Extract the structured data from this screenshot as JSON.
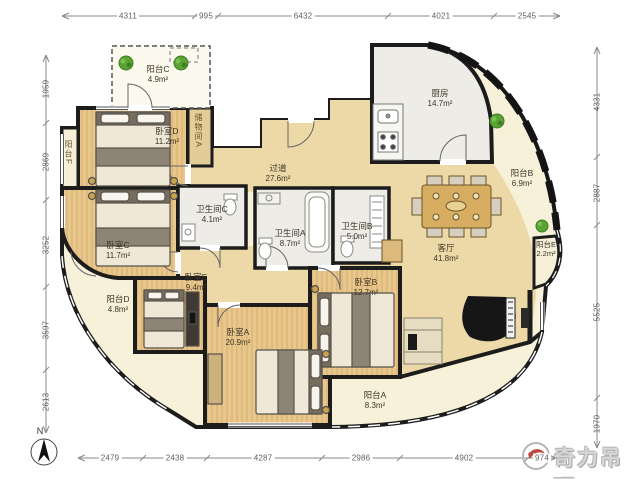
{
  "dimensions": {
    "top": [
      "4311",
      "995",
      "6432",
      "4021",
      "2545"
    ],
    "bottom": [
      "2479",
      "2438",
      "4287",
      "2986",
      "4902",
      "974"
    ],
    "left": [
      "1959",
      "2869",
      "3252",
      "3597",
      "2613"
    ],
    "right": [
      "4331",
      "2887",
      "5525",
      "1970"
    ]
  },
  "rooms": {
    "balcony_c": {
      "name": "阳台C",
      "area": "4.9m²"
    },
    "bedroom_d": {
      "name": "卧室D",
      "area": "11.2m²"
    },
    "storage_a": {
      "name": "储物间A"
    },
    "balcony_f": {
      "name": "阳台F"
    },
    "bedroom_c": {
      "name": "卧室C",
      "area": "11.7m²"
    },
    "bathroom_c": {
      "name": "卫生间C",
      "area": "4.1m²"
    },
    "corridor": {
      "name": "过道",
      "area": "27.6m²"
    },
    "bathroom_a": {
      "name": "卫生间A",
      "area": "8.7m²"
    },
    "bathroom_b": {
      "name": "卫生间B",
      "area": "5.0m²"
    },
    "kitchen": {
      "name": "厨房",
      "area": "14.7m²"
    },
    "balcony_b": {
      "name": "阳台B",
      "area": "6.9m²"
    },
    "living_room": {
      "name": "客厅",
      "area": "41.8m²"
    },
    "balcony_e": {
      "name": "阳台E",
      "area": "2.2m²"
    },
    "bedroom_e": {
      "name": "卧室E",
      "area": "9.4m²"
    },
    "balcony_d": {
      "name": "阳台D",
      "area": "4.8m²"
    },
    "bedroom_a": {
      "name": "卧室A",
      "area": "20.9m²"
    },
    "bedroom_b": {
      "name": "卧室B",
      "area": "12.7m²"
    },
    "balcony_a": {
      "name": "阳台A",
      "area": "8.3m²"
    }
  },
  "compass": {
    "label": "N"
  },
  "watermark": {
    "text": "奇力吊顶"
  },
  "colors": {
    "wall": "#1c1c1c",
    "wood_floor": "#e8c78c",
    "living_floor": "#ecd9a7",
    "balcony_floor": "#f7f1da",
    "bathroom_floor": "#edece6",
    "plant_green": "#4f9e2f",
    "dimension_text": "#5f5f5f"
  }
}
